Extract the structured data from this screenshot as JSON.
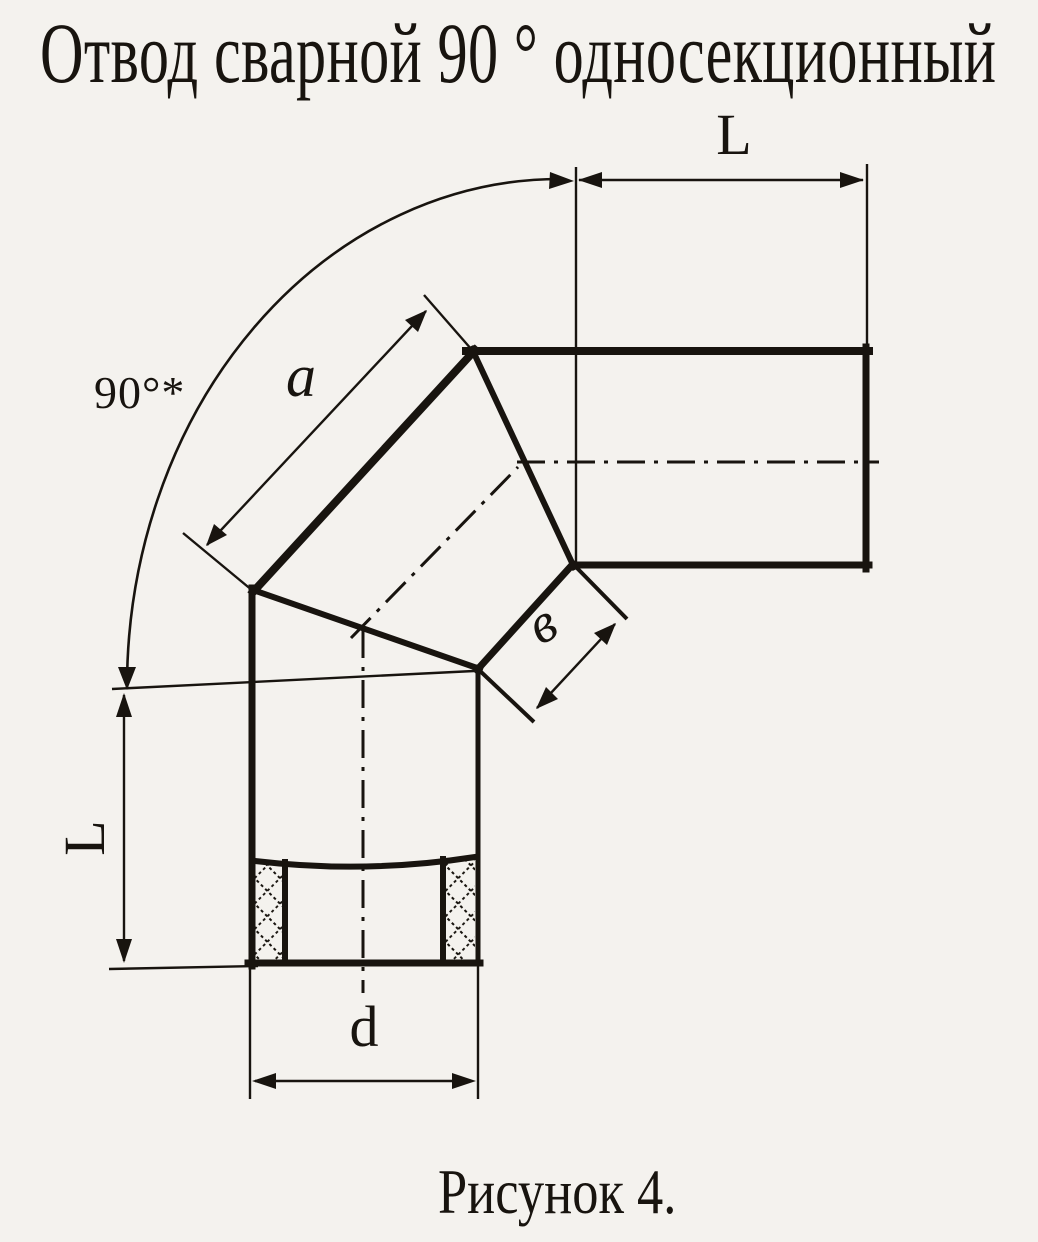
{
  "theme": {
    "paper": "#f4f2ee",
    "ink": "#18140f"
  },
  "title": "Отвод сварной 90 ° односекционный",
  "caption": "Рисунок 4.",
  "dimensions": {
    "top_length_label": "L",
    "left_length_label": "L",
    "bend_angle_label": "90°*",
    "segment_outer_side_label": "a",
    "segment_inner_side_label": "в",
    "diameter_label": "d"
  }
}
